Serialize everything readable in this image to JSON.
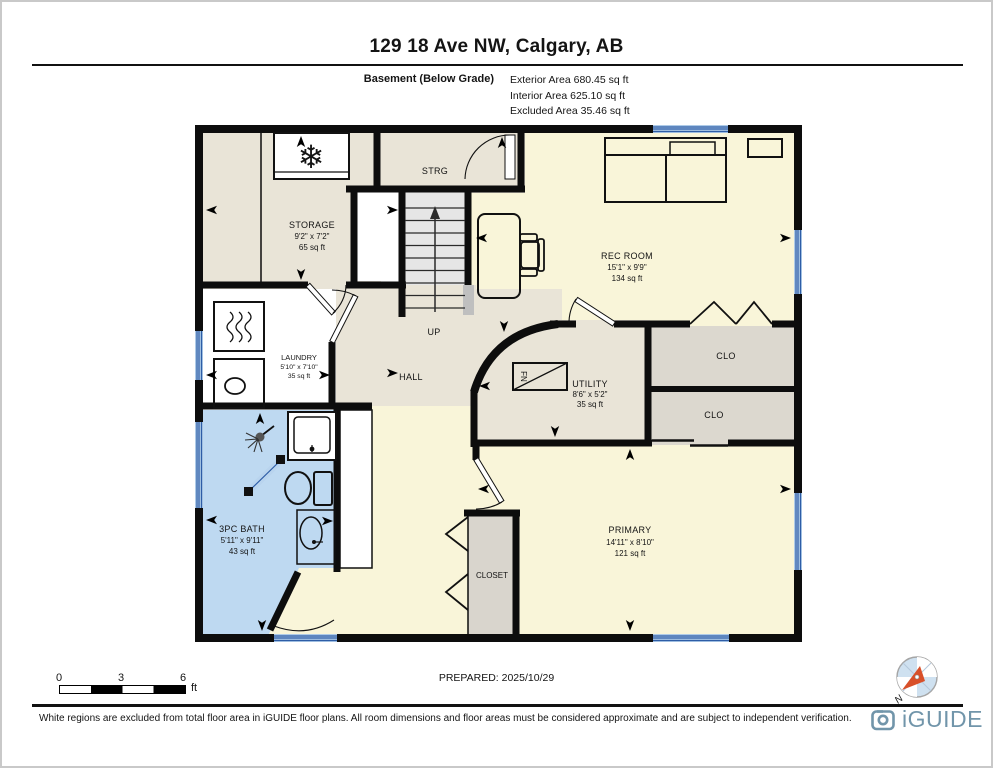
{
  "page": {
    "title": "129 18 Ave NW, Calgary, AB",
    "prepared": "PREPARED: 2025/10/29",
    "disclaimer": "White regions are excluded from total floor area in iGUIDE floor plans. All room dimensions and floor areas must be considered approximate and are subject to independent verification.",
    "brand": "iGUIDE",
    "north_label": "N"
  },
  "legend": {
    "floor": "Basement (Below Grade)",
    "stats": [
      "Exterior Area 680.45 sq ft",
      "Interior Area 625.10 sq ft",
      "Excluded Area 35.46 sq ft"
    ]
  },
  "scale_bar": {
    "ticks": [
      "0",
      "3",
      "6"
    ],
    "unit": "ft"
  },
  "rooms": {
    "storage": {
      "name": "STORAGE",
      "dims": "9'2\" x 7'2\"",
      "area": "65 sq ft"
    },
    "strg": {
      "name": "STRG"
    },
    "rec_room": {
      "name": "REC ROOM",
      "dims": "15'1\" x 9'9\"",
      "area": "134 sq ft"
    },
    "laundry": {
      "name": "LAUNDRY",
      "dims": "5'10\" x 7'10\"",
      "area": "35 sq ft"
    },
    "hall": {
      "name": "HALL"
    },
    "up": {
      "name": "UP"
    },
    "utility": {
      "name": "UTILITY",
      "dims": "8'6\" x 5'2\"",
      "area": "35 sq ft"
    },
    "clo_upper": {
      "name": "CLO"
    },
    "clo_lower": {
      "name": "CLO"
    },
    "bath": {
      "name": "3PC BATH",
      "dims": "5'11\" x 9'11\"",
      "area": "43 sq ft"
    },
    "closet": {
      "name": "CLOSET"
    },
    "primary": {
      "name": "PRIMARY",
      "dims": "14'11\" x 8'10\"",
      "area": "121 sq ft"
    },
    "furnace": {
      "name": "FN"
    }
  },
  "colors": {
    "wall": "#0d0d0d",
    "room_beige": "#e9e4d7",
    "room_yellow": "#f9f5d9",
    "bath_blue": "#bed9f1",
    "closet_gray": "#dcd8cf",
    "stairs_gray": "#e6e6e6",
    "window_fill": "#aecbe8",
    "window_stripe": "#2e5da6",
    "brand_blue": "#7195aa",
    "compass_red": "#d8502a"
  }
}
